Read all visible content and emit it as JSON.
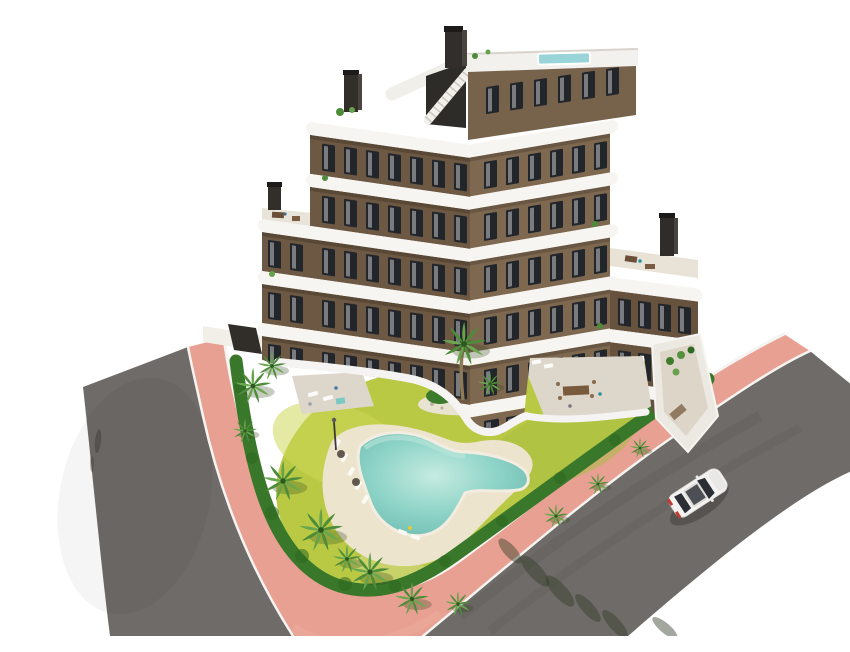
{
  "scene": {
    "description": "Aerial 3D architectural rendering of a modern six-storey apartment complex with curved white wrap-around balconies and brown facades, a rooftop deck with plunge pool, landscaped garden with free-form turquoise swimming pool, sun loungers and palm trees, enclosed by a green hedge, salmon-pink sidewalks and grey asphalt roads with a single white car",
    "background": "#ffffff"
  },
  "colors": {
    "asphalt": "#6f6b69",
    "sidewalk": "#e7a092",
    "curb": "#f6f4f1",
    "hedge": "#39782a",
    "lawn": "#b9c944",
    "lawn_light": "#cdd757",
    "pool_water": "#8fd4c8",
    "pool_deck": "#ece4cd",
    "stone": "#ddd6ca",
    "facade_left": "#6d5843",
    "facade_right": "#7e6850",
    "facade_side": "#67523e",
    "balcony": "#f7f5f1",
    "window": "#22262b",
    "roof_pool": "#98d4d8",
    "palm": "#4d8c38",
    "palm_light": "#6aa84f",
    "car": "#f3f2f0"
  },
  "building": {
    "storeys": 6,
    "wings": 2,
    "balcony_style": "curved white wrap-around balconies",
    "features": [
      "rooftop plunge pool",
      "roof terraces with outdoor furniture",
      "external staircase",
      "chimneys",
      "ground-floor terraces"
    ]
  },
  "garden": {
    "features": [
      "free-form turquoise pool",
      "sand-colored pool deck",
      "sun loungers with parasols",
      "palm trees",
      "perimeter hedge",
      "yellow-green lawn",
      "central palm island",
      "stone patio with dining set"
    ]
  },
  "street": {
    "car_count": 1,
    "car_color": "white",
    "sidewalk_color_name": "salmon pink",
    "roads": [
      "curved road on the left",
      "diagonal road on the right"
    ]
  }
}
